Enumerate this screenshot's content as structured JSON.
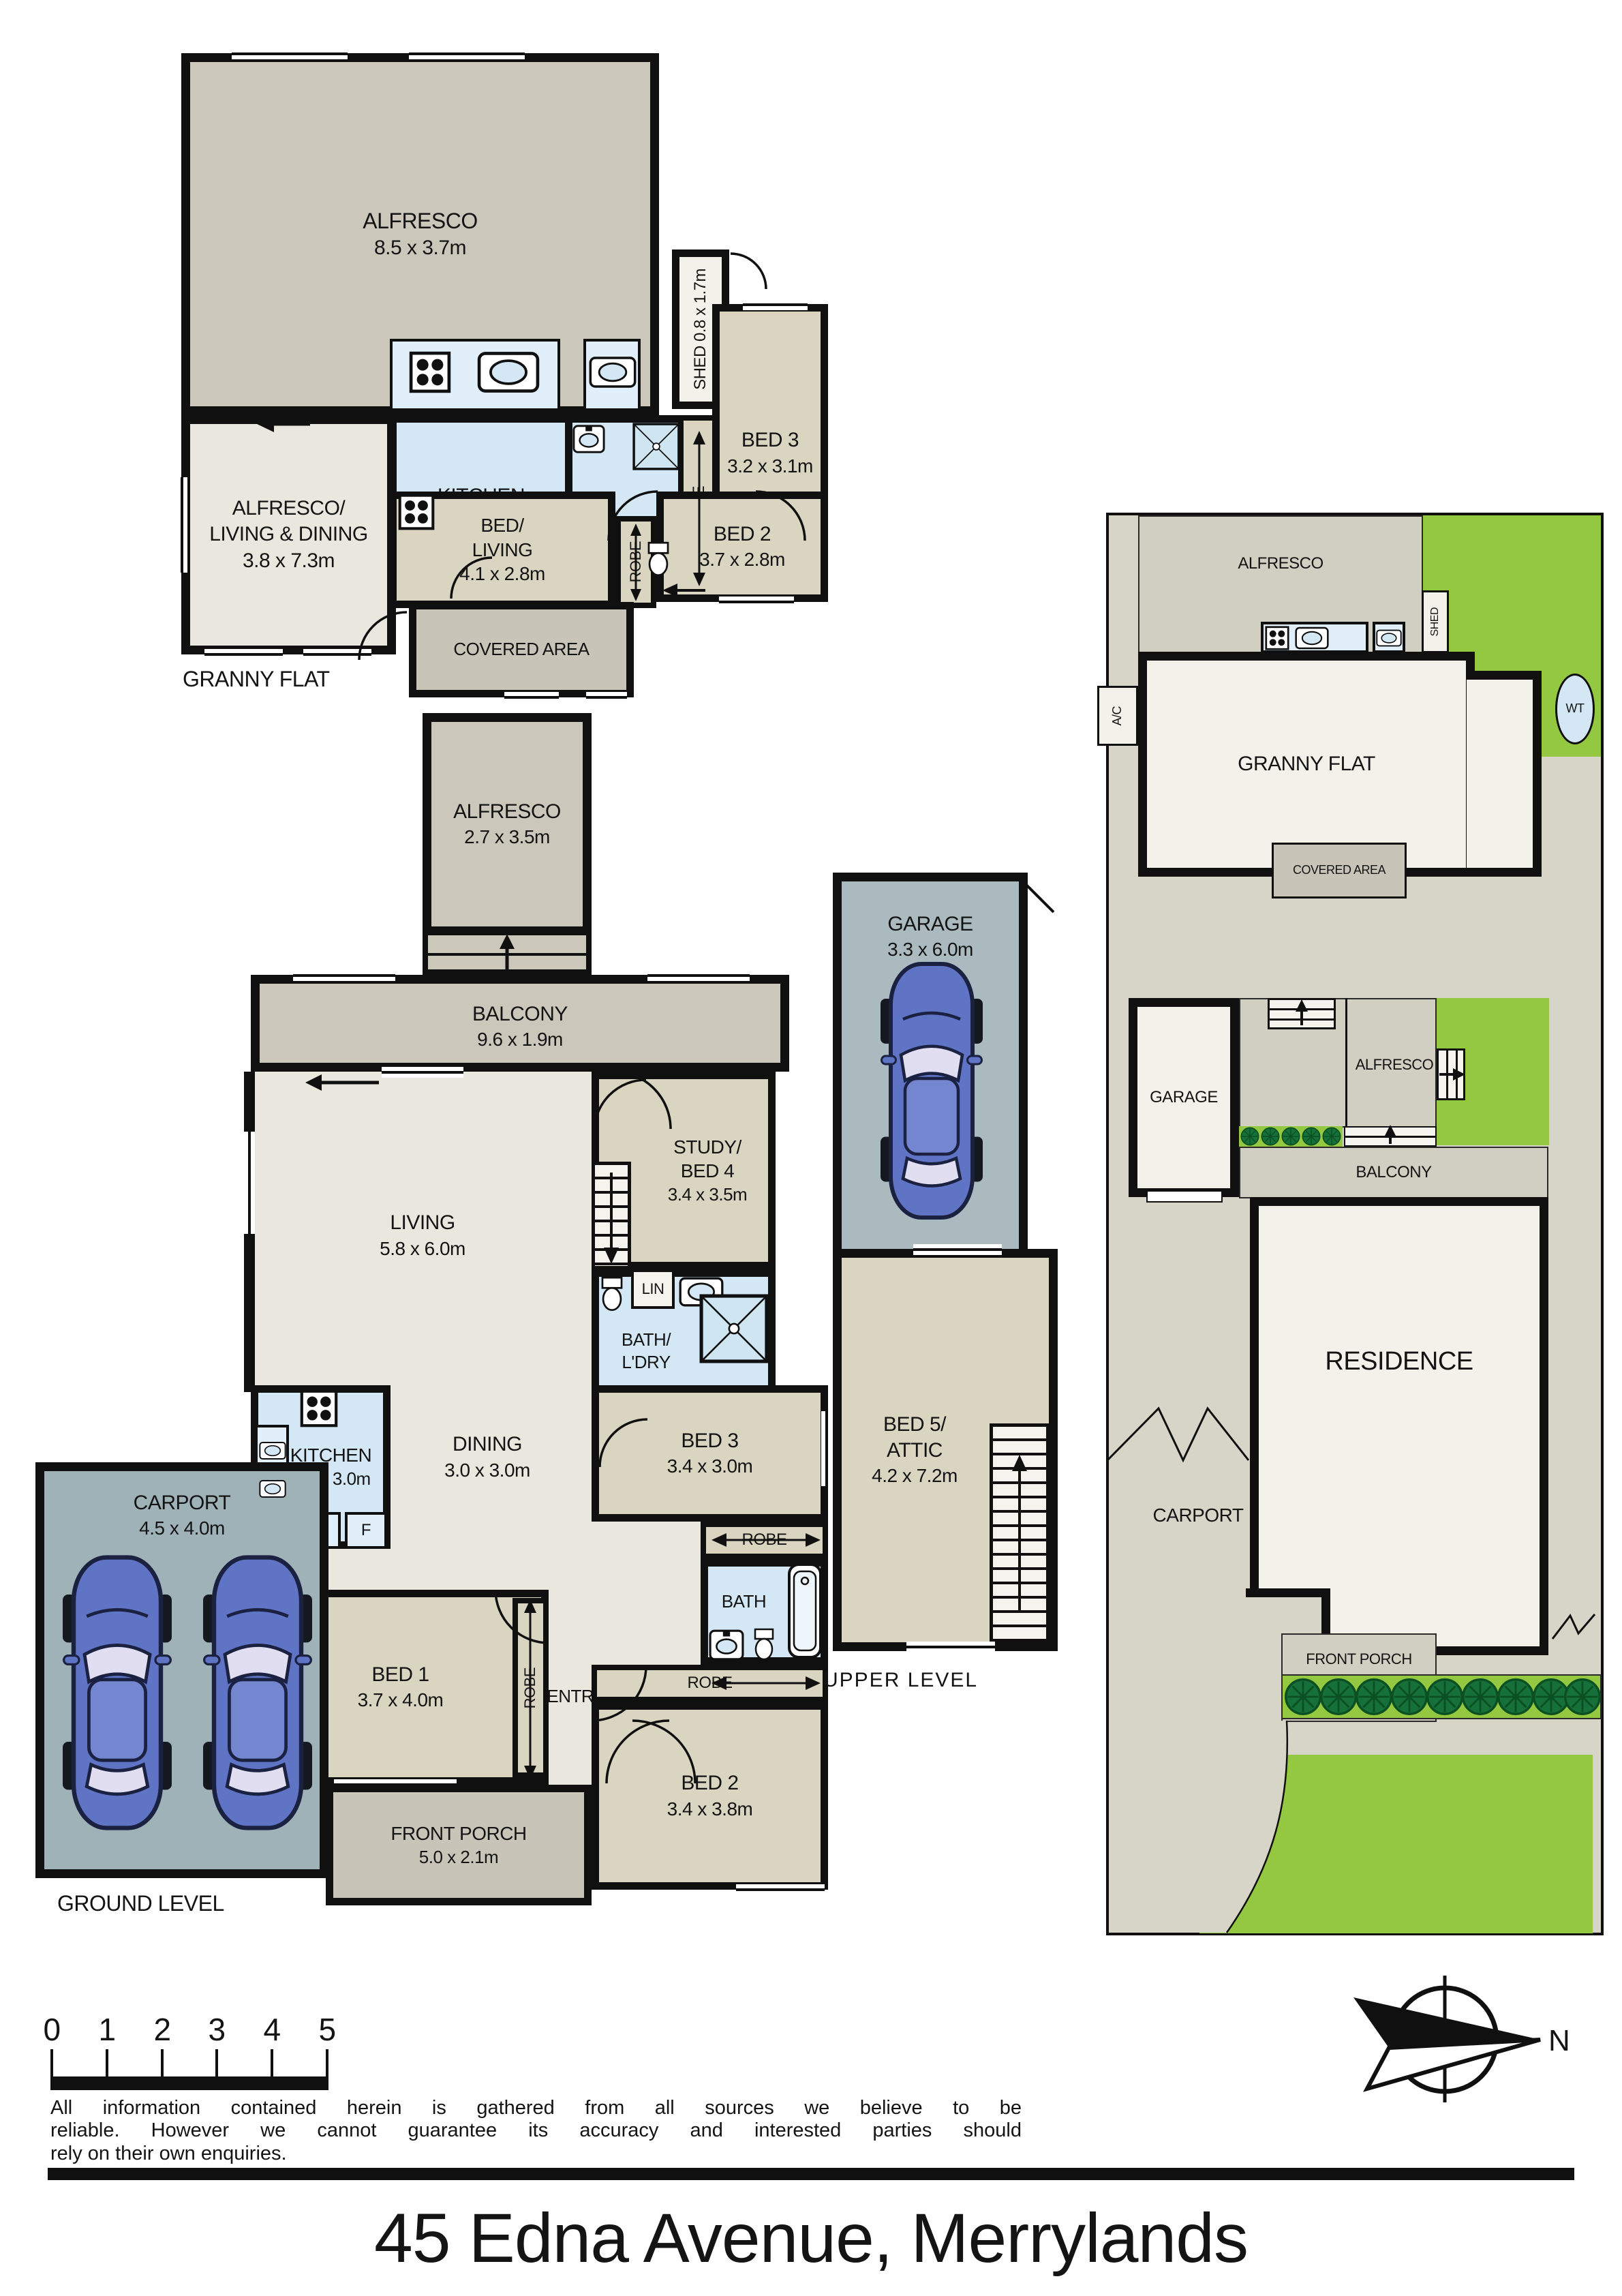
{
  "page": {
    "title": "45 Edna Avenue, Merrylands"
  },
  "gf": {
    "label": "GRANNY FLAT",
    "alfresco": "ALFRESCO",
    "alfresco_dims": "8.5 x 3.7m",
    "shed": "SHED 0.8 x 1.7m",
    "living1": "ALFRESCO/",
    "living2": "LIVING & DINING",
    "living_dims": "3.8 x 7.3m",
    "kitchen": "KITCHEN",
    "kitchen_dims": "3.2 x 3.1m",
    "fridge": "F",
    "bath": "BATH",
    "robe1": "ROBE",
    "bed3": "BED 3",
    "bed3_dims": "3.2 x 3.1m",
    "bedliving1": "BED/",
    "bedliving2": "LIVING",
    "bedliving_dims": "4.1 x 2.8m",
    "robe2": "ROBE",
    "bed2": "BED 2",
    "bed2_dims": "3.7 x 2.8m",
    "covered": "COVERED AREA"
  },
  "gl": {
    "label": "GROUND LEVEL",
    "alfresco": "ALFRESCO",
    "alfresco_dims": "2.7 x 3.5m",
    "balcony": "BALCONY",
    "balcony_dims": "9.6 x 1.9m",
    "living": "LIVING",
    "living_dims": "5.8 x 6.0m",
    "study1": "STUDY/",
    "study2": "BED 4",
    "study_dims": "3.4 x 3.5m",
    "lin1": "LIN",
    "bathldry1": "BATH/",
    "bathldry2": "L'DRY",
    "kitchen": "KITCHEN",
    "kitchen_dims": "3.0 x 3.0m",
    "pantry": "P",
    "fridge": "F",
    "dining": "DINING",
    "dining_dims": "3.0 x 3.0m",
    "bed3": "BED 3",
    "bed3_dims": "3.4 x 3.0m",
    "robe_bed3": "ROBE",
    "bath": "BATH",
    "lin2": "LIN",
    "entry": "ENTRY",
    "bed1": "BED 1",
    "bed1_dims": "3.7 x 4.0m",
    "robe_bed1": "ROBE",
    "robe_bed2": "ROBE",
    "bed2": "BED 2",
    "bed2_dims": "3.4 x 3.8m",
    "porch": "FRONT PORCH",
    "porch_dims": "5.0 x 2.1m",
    "carport": "CARPORT",
    "carport_dims": "4.5 x 4.0m"
  },
  "garage": {
    "name": "GARAGE",
    "dims": "3.3 x 6.0m"
  },
  "upper": {
    "label": "UPPER LEVEL",
    "l1": "BED 5/",
    "l2": "ATTIC",
    "dims": "4.2 x 7.2m"
  },
  "site": {
    "alfresco_top": "ALFRESCO",
    "shed": "SHED",
    "ac": "A/C",
    "wt": "WT",
    "granny": "GRANNY FLAT",
    "covered": "COVERED AREA",
    "garage": "GARAGE",
    "alfresco_mid": "ALFRESCO",
    "balcony": "BALCONY",
    "residence": "RESIDENCE",
    "carport": "CARPORT",
    "porch": "FRONT PORCH"
  },
  "footer": {
    "scale_ticks": [
      "0",
      "1",
      "2",
      "3",
      "4",
      "5"
    ],
    "disclaimer_line1": "All information contained herein is gathered from all sources we believe to be",
    "disclaimer_line2": "reliable. However we cannot guarantee its accuracy and interested parties should",
    "disclaimer_line3": "rely on their own enquiries.",
    "north": "N"
  },
  "colors": {
    "wall": "#101010",
    "alfresco_grey": "#cbc8bb",
    "covered_grey": "#c8c5b8",
    "living_cream": "#eae7de",
    "bedroom_beige": "#d9d5c1",
    "wet_blue": "#d3e8f4",
    "carport_grey": "#9fb2b8",
    "garage_grey": "#abbabf",
    "site_ground": "#d7d4c8",
    "site_building": "#f2f1ea",
    "lawn_green": "#93c840",
    "tree_green": "#16703a",
    "car_blue": "#6074c6"
  }
}
